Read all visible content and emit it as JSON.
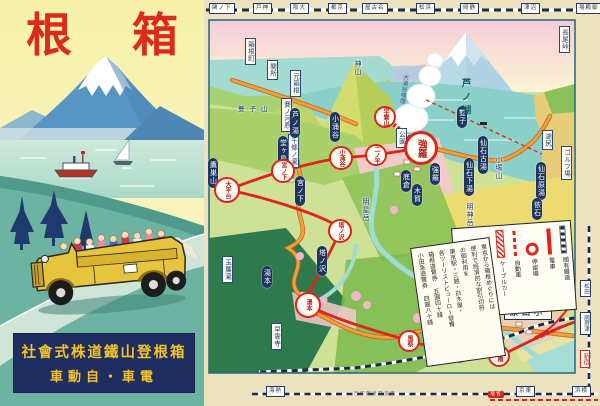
{
  "poster": {
    "title_left": "根",
    "title_right": "箱",
    "company_line1": "社會式株道鐵山登根箱",
    "company_line2": "車動自・車電",
    "colors": {
      "title_red": "#dc2a1c",
      "box_navy": "#202d5f",
      "text_gold": "#f1c32c",
      "bus_yellow": "#e7c43e"
    }
  },
  "map": {
    "odawara_display": "原田小",
    "odakyu_label": "小田原急行",
    "bottom_caption": {
      "t": "行印部通交道鐵",
      "x": 150
    },
    "bottom_red": {
      "t": "電省",
      "x": 284
    },
    "shinjuku": {
      "t": "新宿",
      "x": 376,
      "y": 350
    },
    "top_stations": [
      {
        "t": "関ノ下",
        "x": 5
      },
      {
        "t": "戸神",
        "x": 49
      },
      {
        "t": "阪大",
        "x": 86
      },
      {
        "t": "都京",
        "x": 124
      },
      {
        "t": "屋古名",
        "x": 158
      },
      {
        "t": "松浜",
        "x": 212
      },
      {
        "t": "岡静",
        "x": 256
      },
      {
        "t": "津沼",
        "x": 317
      },
      {
        "t": "場殿御",
        "x": 372
      }
    ],
    "bottom_boxes": [
      {
        "t": "海熱",
        "x": 62
      },
      {
        "t": "京東",
        "x": 312
      },
      {
        "t": "浜横",
        "x": 368
      }
    ],
    "right_boxes": [
      {
        "t": "松田",
        "x": 376,
        "y": 280
      },
      {
        "t": "國府津",
        "x": 376,
        "y": 312
      }
    ],
    "stations": [
      {
        "t": "湯本",
        "x": 104,
        "y": 305,
        "d": 26
      },
      {
        "t": "塔ノ沢",
        "x": 136,
        "y": 231,
        "d": 24
      },
      {
        "t": "大平台",
        "x": 23,
        "y": 190,
        "d": 26
      },
      {
        "t": "宮ノ下",
        "x": 79,
        "y": 171,
        "d": 24
      },
      {
        "t": "小涌谷",
        "x": 137,
        "y": 158,
        "d": 24
      },
      {
        "t": "二ノ平",
        "x": 172,
        "y": 155,
        "d": 22
      },
      {
        "t": "強羅",
        "x": 217,
        "y": 148,
        "d": 34,
        "big": true
      },
      {
        "t": "早雲山",
        "x": 181,
        "y": 117,
        "d": 22
      },
      {
        "t": "風祭",
        "x": 205,
        "y": 341,
        "d": 22
      },
      {
        "t": "入生田",
        "x": 255,
        "y": 352,
        "d": 22
      },
      {
        "t": "板橋",
        "x": 295,
        "y": 356,
        "d": 22
      }
    ],
    "pills": [
      {
        "t": "湯本",
        "x": 58,
        "y": 266
      },
      {
        "t": "塔ノ沢",
        "x": 113,
        "y": 246
      },
      {
        "t": "宮ノ下",
        "x": 91,
        "y": 176
      },
      {
        "t": "堂ヶ島",
        "x": 74,
        "y": 136
      },
      {
        "t": "芦ノ湯",
        "x": 86,
        "y": 108
      },
      {
        "t": "小涌谷",
        "x": 126,
        "y": 112
      },
      {
        "t": "底倉",
        "x": 197,
        "y": 170
      },
      {
        "t": "木賀",
        "x": 208,
        "y": 184
      },
      {
        "t": "強羅",
        "x": 226,
        "y": 163
      },
      {
        "t": "雙子",
        "x": 253,
        "y": 106
      },
      {
        "t": "仙石古湯",
        "x": 274,
        "y": 136
      },
      {
        "t": "仙石下湯",
        "x": 260,
        "y": 158
      },
      {
        "t": "仙石原湯",
        "x": 332,
        "y": 162
      },
      {
        "t": "依石",
        "x": 328,
        "y": 198
      },
      {
        "t": "鷹巣山",
        "x": 4,
        "y": 158
      }
    ],
    "wboxes": [
      {
        "t": "箱根町",
        "x": 41,
        "y": 38
      },
      {
        "t": "關所",
        "x": 63,
        "y": 60
      },
      {
        "t": "元箱根",
        "x": 86,
        "y": 70
      },
      {
        "t": "賽ノ河原",
        "x": 77,
        "y": 98
      },
      {
        "t": "千條ノ瀧",
        "x": 84,
        "y": 134
      },
      {
        "t": "玉簾瀧",
        "x": 18,
        "y": 256
      },
      {
        "t": "早雲寺",
        "x": 67,
        "y": 323
      },
      {
        "t": "湖尻",
        "x": 338,
        "y": 130
      },
      {
        "t": "ゴルフ場",
        "x": 357,
        "y": 146
      },
      {
        "t": "長尾峠",
        "x": 355,
        "y": 26
      },
      {
        "t": "公園",
        "x": 192,
        "y": 128
      }
    ],
    "terrain": [
      {
        "t": "芦ノ湖",
        "x": 256,
        "y": 78,
        "cls": "lake"
      },
      {
        "t": "神山",
        "x": 150,
        "y": 60,
        "cls": "mt"
      },
      {
        "t": "明神岳",
        "x": 262,
        "y": 203,
        "cls": "mt"
      },
      {
        "t": "明星岳",
        "x": 158,
        "y": 198,
        "cls": "mt"
      },
      {
        "t": "小塚山",
        "x": 291,
        "y": 156,
        "cls": "mt"
      },
      {
        "t": "雙子山",
        "x": 34,
        "y": 106,
        "cls": "mt-h"
      },
      {
        "t": "大涌谷噴煙",
        "x": 196,
        "y": 74,
        "cls": "steam"
      }
    ],
    "legend": {
      "items": [
        {
          "label": "國有鐵道",
          "sym": "dash"
        },
        {
          "label": "電車",
          "sym": "redline"
        },
        {
          "label": "停留場",
          "sym": "ring"
        },
        {
          "label": "自動車",
          "sym": "reddash"
        },
        {
          "label": "ケーブルカー",
          "sym": "hatch"
        },
        {
          "label": "温泉場",
          "sym": "sq"
        },
        {
          "label": "遊覧地",
          "sym": "sq2"
        }
      ]
    },
    "ad_lines": [
      "東京から箱根めぐりには",
      "便利で經濟的な割引切符",
      "の御利用を",
      "東京駅・三越・白木屋・",
      "各ツーリストビューロー發賣",
      "箱根遊覽券 五圓四十錢",
      "小田急遊覽券 四圓八十錢"
    ]
  }
}
